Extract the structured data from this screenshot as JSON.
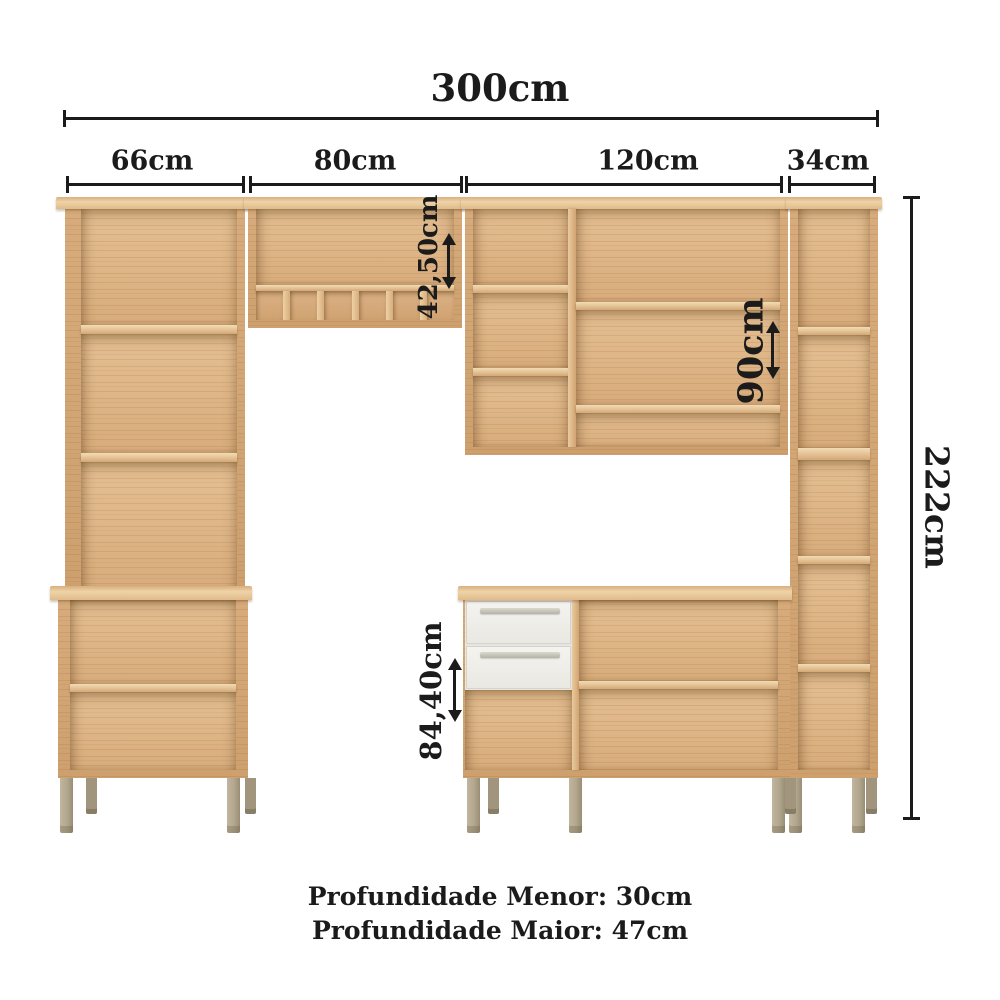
{
  "dims": {
    "total_width": "300cm",
    "segments": [
      {
        "label": "66cm"
      },
      {
        "label": "80cm"
      },
      {
        "label": "120cm"
      },
      {
        "label": "34cm"
      }
    ],
    "total_height": "222cm",
    "upper_cabinet_height": "42,50cm",
    "hutch_height": "90cm",
    "base_cabinet_height": "84,40cm"
  },
  "footer": {
    "depth_minor": "Profundidade Menor: 30cm",
    "depth_major": "Profundidade Maior: 47cm"
  },
  "colors": {
    "background": "#ffffff",
    "dimension_ink": "#1b1b1b",
    "wood_base": "#ddb486",
    "wood_frame": "#d2a675",
    "wood_light": "#eed3a8",
    "wood_grain": "#c29a6a",
    "drawer_front": "#f2f1ed",
    "drawer_handle": "#c9c6bc",
    "leg": "#b2a78e"
  }
}
